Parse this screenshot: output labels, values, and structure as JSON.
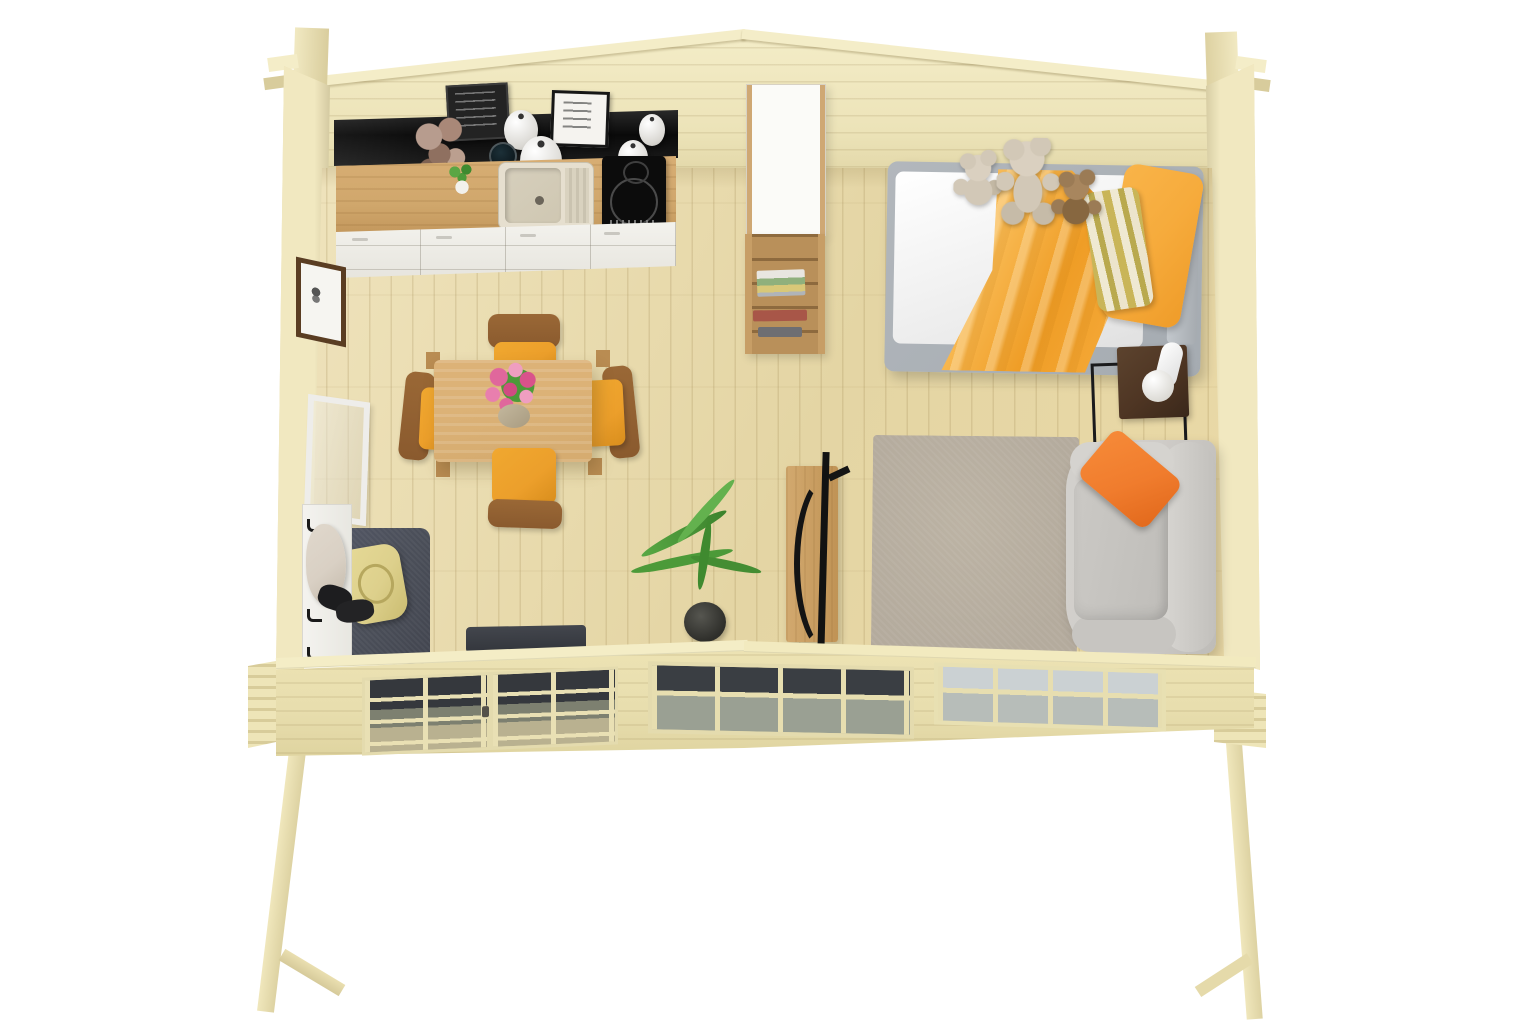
{
  "meta": {
    "title": "Overhead 3D render of a one-room log cabin interior"
  },
  "palette": {
    "bg": "#ffffff",
    "pine": "#ece3b8",
    "pineLight": "#f4edc8",
    "pineEdge": "#d8cc9c",
    "pineFront": "#e8deae",
    "floorA": "#efe3bc",
    "floorB": "#e4d5a4",
    "counterBlack": "#141414",
    "counterWood": "#d0a76c",
    "cabinetWhite": "#f3f2ed",
    "sinkBeige": "#e6dfcf",
    "cooktop": "#0c0c0c",
    "wardrobeWhite": "#fbfbf8",
    "shelfWood": "#c79e66",
    "bedFrame": "#a5abb1",
    "mattress": "#ffffff",
    "blanketA": "#f9bb55",
    "blanketB": "#ef9d26",
    "pillowOrange": "#f6ab3c",
    "stripeYellow": "#c9b558",
    "stripeCream": "#efe9d2",
    "bearCream": "#d2c8b7",
    "bearBrown": "#9b7b55",
    "sofaGray": "#cfccc8",
    "sofaPillow": "#f07c2d",
    "rug": "#b4ab9d",
    "nightstand": "#4e3523",
    "metal": "#1a1a1c",
    "lamp": "#f4f3ef",
    "tableWood": "#d6ac70",
    "chairWood": "#8a5a2e",
    "seatOrange": "#ec9f2b",
    "flowerPink": "#e0679c",
    "leafGreen": "#4c9a39",
    "matDark": "#4a4e58",
    "bagYellow": "#ddd08c",
    "coatBeige": "#d9d0c4",
    "glassDark": "#35383d",
    "glassLight": "#cbd1d3",
    "chalkBoard": "#232323",
    "signWhite": "#f5f3ef",
    "pictureFrame": "#5a3d22",
    "black": "#141414"
  },
  "scene": {
    "description": "Top-down 3D architectural render of a small log cabin studio on raised corner posts: kitchen with black wall shelf, decorative signs, sink, cooktop and white drawer cabinets along the back wall; white wardrobe and open bookshelf; bed with orange bedding, striped pillow and three teddy bears; nightstand with lamp; grey sofa with orange cushion on a beige rug; wooden rocking chair and potted palm; dining table with flower bouquet and four orange-seat chairs; entry corner with leaning mirror, coat hooks, shoes and a dark mat with a tote bag; glazed double door and two multi-pane windows in the front wall.",
    "objects": [
      {
        "id": "back-gable-wall",
        "label": "Back gable wall"
      },
      {
        "id": "left-side-wall",
        "label": "Left side wall"
      },
      {
        "id": "right-side-wall",
        "label": "Right side wall"
      },
      {
        "id": "front-wall",
        "label": "Front wall"
      },
      {
        "id": "front-door",
        "label": "Glazed double front door"
      },
      {
        "id": "front-window-middle",
        "label": "Front window (middle)"
      },
      {
        "id": "front-window-right",
        "label": "Front window (right)"
      },
      {
        "id": "front-post-left",
        "label": "Front left corner post"
      },
      {
        "id": "front-post-right",
        "label": "Front right corner post"
      },
      {
        "id": "kitchen-shelf",
        "label": "Black kitchen shelf"
      },
      {
        "id": "chalkboard-sign",
        "label": "Chalkboard sign with hand lettering"
      },
      {
        "id": "framed-sign",
        "label": "Framed sign with lettering"
      },
      {
        "id": "kitchen-counter",
        "label": "Kitchen counter"
      },
      {
        "id": "kitchen-sink",
        "label": "Kitchen sink"
      },
      {
        "id": "cooktop",
        "label": "Induction cooktop"
      },
      {
        "id": "kitchen-cabinets",
        "label": "Kitchen drawer cabinets"
      },
      {
        "id": "wardrobe",
        "label": "White wardrobe cabinet"
      },
      {
        "id": "bookshelf",
        "label": "Open shelf with books"
      },
      {
        "id": "bed",
        "label": "Bed with orange bedding"
      },
      {
        "id": "teddy-bear",
        "label": "Teddy bears"
      },
      {
        "id": "nightstand",
        "label": "Nightstand with reading lamp"
      },
      {
        "id": "rug",
        "label": "Area rug"
      },
      {
        "id": "sofa",
        "label": "Sofa with orange cushion"
      },
      {
        "id": "rocking-chair",
        "label": "Rocking chair"
      },
      {
        "id": "potted-plant",
        "label": "Potted palm plant"
      },
      {
        "id": "dining-table",
        "label": "Dining table with flower bouquet"
      },
      {
        "id": "dining-chair",
        "label": "Dining chair with orange seat pad"
      },
      {
        "id": "mirror-frame",
        "label": "Leaning mirror"
      },
      {
        "id": "coat-rack",
        "label": "Coat rack panel with hooks"
      },
      {
        "id": "entry-mat",
        "label": "Entry mat with tote bag"
      },
      {
        "id": "door-mat",
        "label": "Door mat"
      },
      {
        "id": "wall-picture",
        "label": "Framed picture on side wall"
      }
    ]
  }
}
